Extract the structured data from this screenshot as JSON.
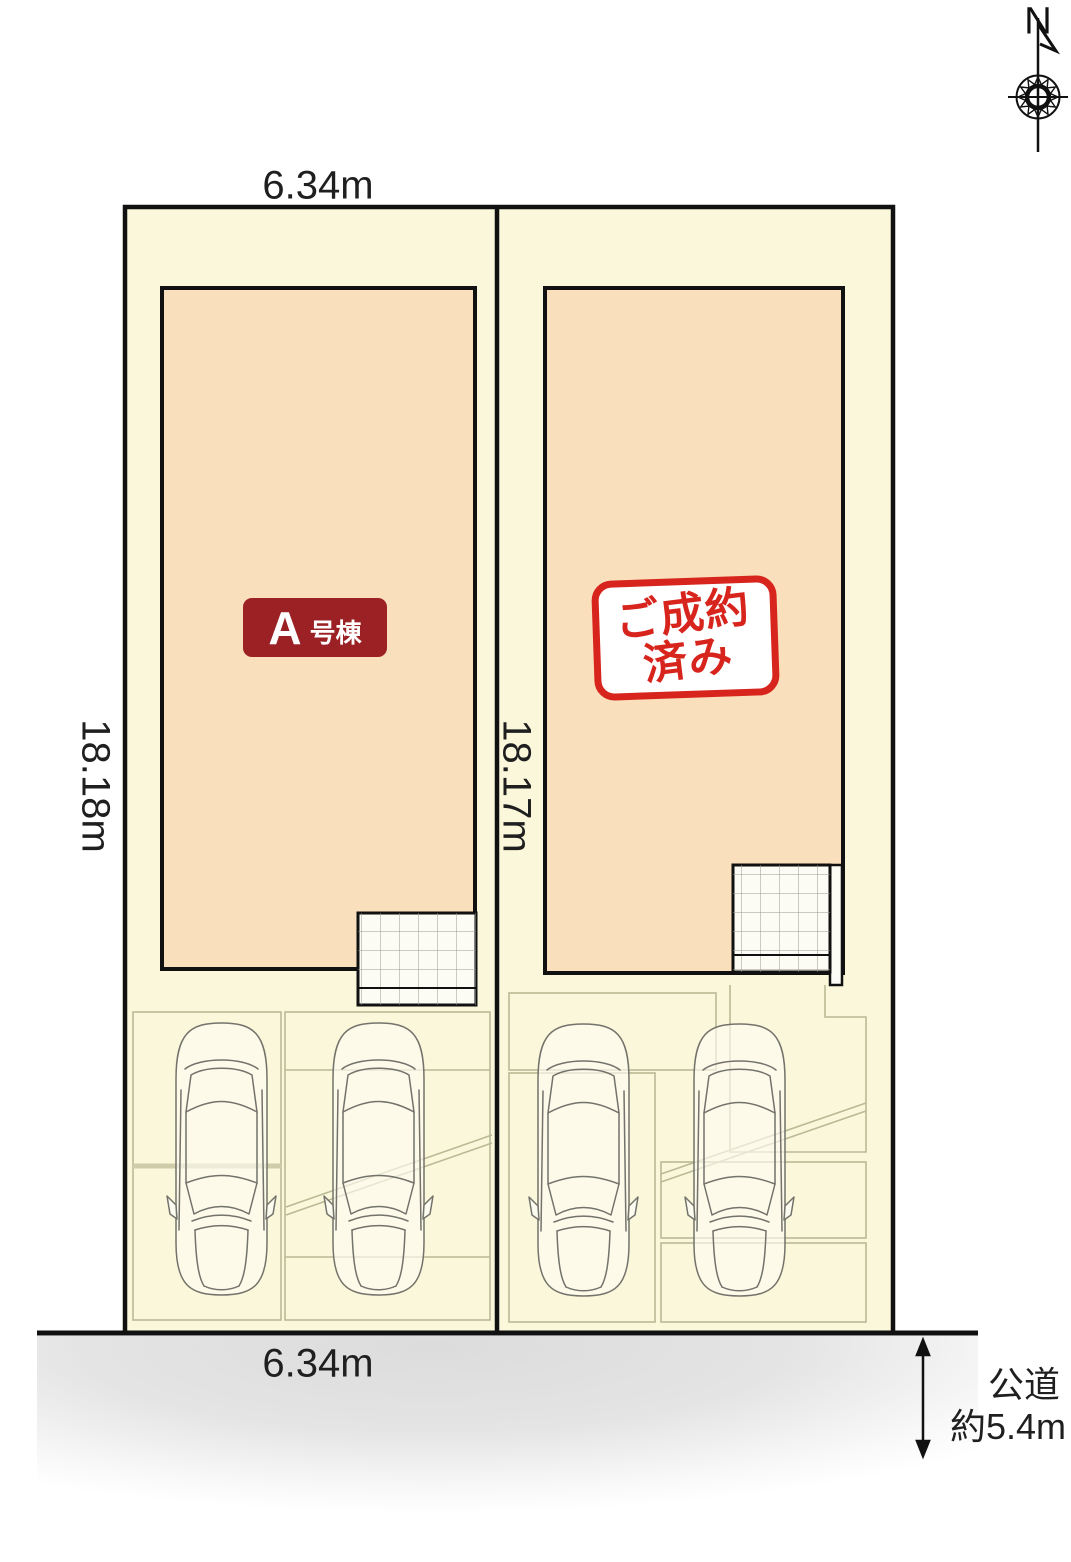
{
  "compass": {
    "north_label": "N"
  },
  "dimensions": {
    "top_width": "6.34m",
    "bottom_width": "6.34m",
    "left_depth": "18.18m",
    "right_depth": "18.17m"
  },
  "lot_a": {
    "badge_unit": "A",
    "badge_suffix": "号棟"
  },
  "lot_b": {
    "stamp_line1": "ご成約",
    "stamp_line2": "済み"
  },
  "road": {
    "name": "公道",
    "width": "約5.4m"
  },
  "colors": {
    "lot_background": "#fbf7da",
    "house_fill": "#f9dfbb",
    "badge_red": "#9b2125",
    "stamp_red": "#d7251d",
    "outline_black": "#111111",
    "parking_line": "#b9ba96",
    "road_gray": "#e0e0e0"
  }
}
